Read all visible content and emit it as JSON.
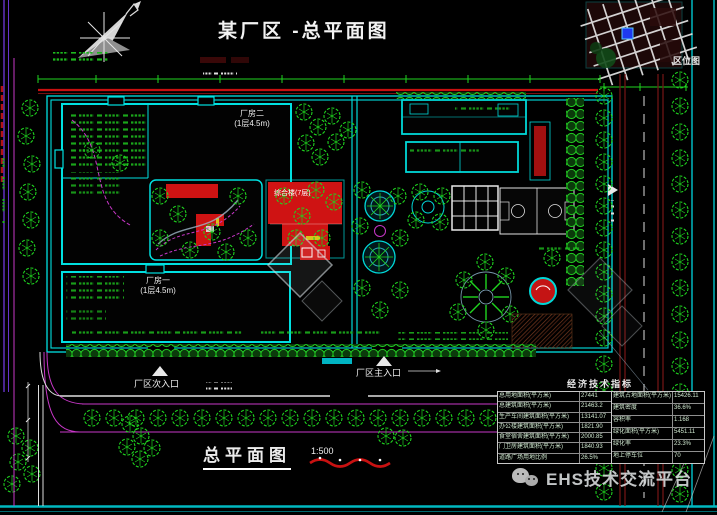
{
  "title": "某厂区 -总平面图",
  "inset": {
    "label": "区位图"
  },
  "plan": {
    "building_a_name": "厂房二",
    "building_a_floors": "(1层4.5m)",
    "building_b_name": "厂房一",
    "building_b_floors": "(1层4.5m)",
    "office_label": "综合楼(7层)",
    "entrance_main": "厂区主入口",
    "entrance_secondary": "厂区次入口"
  },
  "footer": {
    "plan_label": "总平面图",
    "scale": "1:500"
  },
  "table": {
    "title": "经济技术指标",
    "left_rows": [
      {
        "label": "总用地面积(平方米)",
        "value": "27441"
      },
      {
        "label": "总建筑面积(平方米)",
        "value": "21463.2"
      },
      {
        "label": "生产车间建筑面积(平方米)",
        "value": "13141.07"
      },
      {
        "label": "办公楼建筑面积(平方米)",
        "value": "1821.90"
      },
      {
        "label": "食堂宿舍建筑面积(平方米)",
        "value": "2000.85"
      },
      {
        "label": "门卫房建筑面积(平方米)",
        "value": "1840.93"
      },
      {
        "label": "道路广场用地比例",
        "value": "26.5%"
      }
    ],
    "right_rows": [
      {
        "label": "建筑占地面积(平方米)",
        "value": "15426.11"
      },
      {
        "label": "建筑密度",
        "value": "36.6%"
      },
      {
        "label": "容积率",
        "value": "1.168"
      },
      {
        "label": "绿化面积(平方米)",
        "value": "5451.11"
      },
      {
        "label": "绿化率",
        "value": "23.3%"
      },
      {
        "label": "地上停车位",
        "value": "70"
      }
    ]
  },
  "watermark": {
    "text": "EHS技术交流平台",
    "icon": "wechat-icon"
  },
  "colors": {
    "background": "#000000",
    "cad_cyan": "#00e0e0",
    "cad_green": "#1fd41f",
    "cad_magenta": "#c837c8",
    "cad_red": "#cf1313",
    "road_maroon": "#6e1414",
    "parcel_blue": "#1e3af0"
  }
}
